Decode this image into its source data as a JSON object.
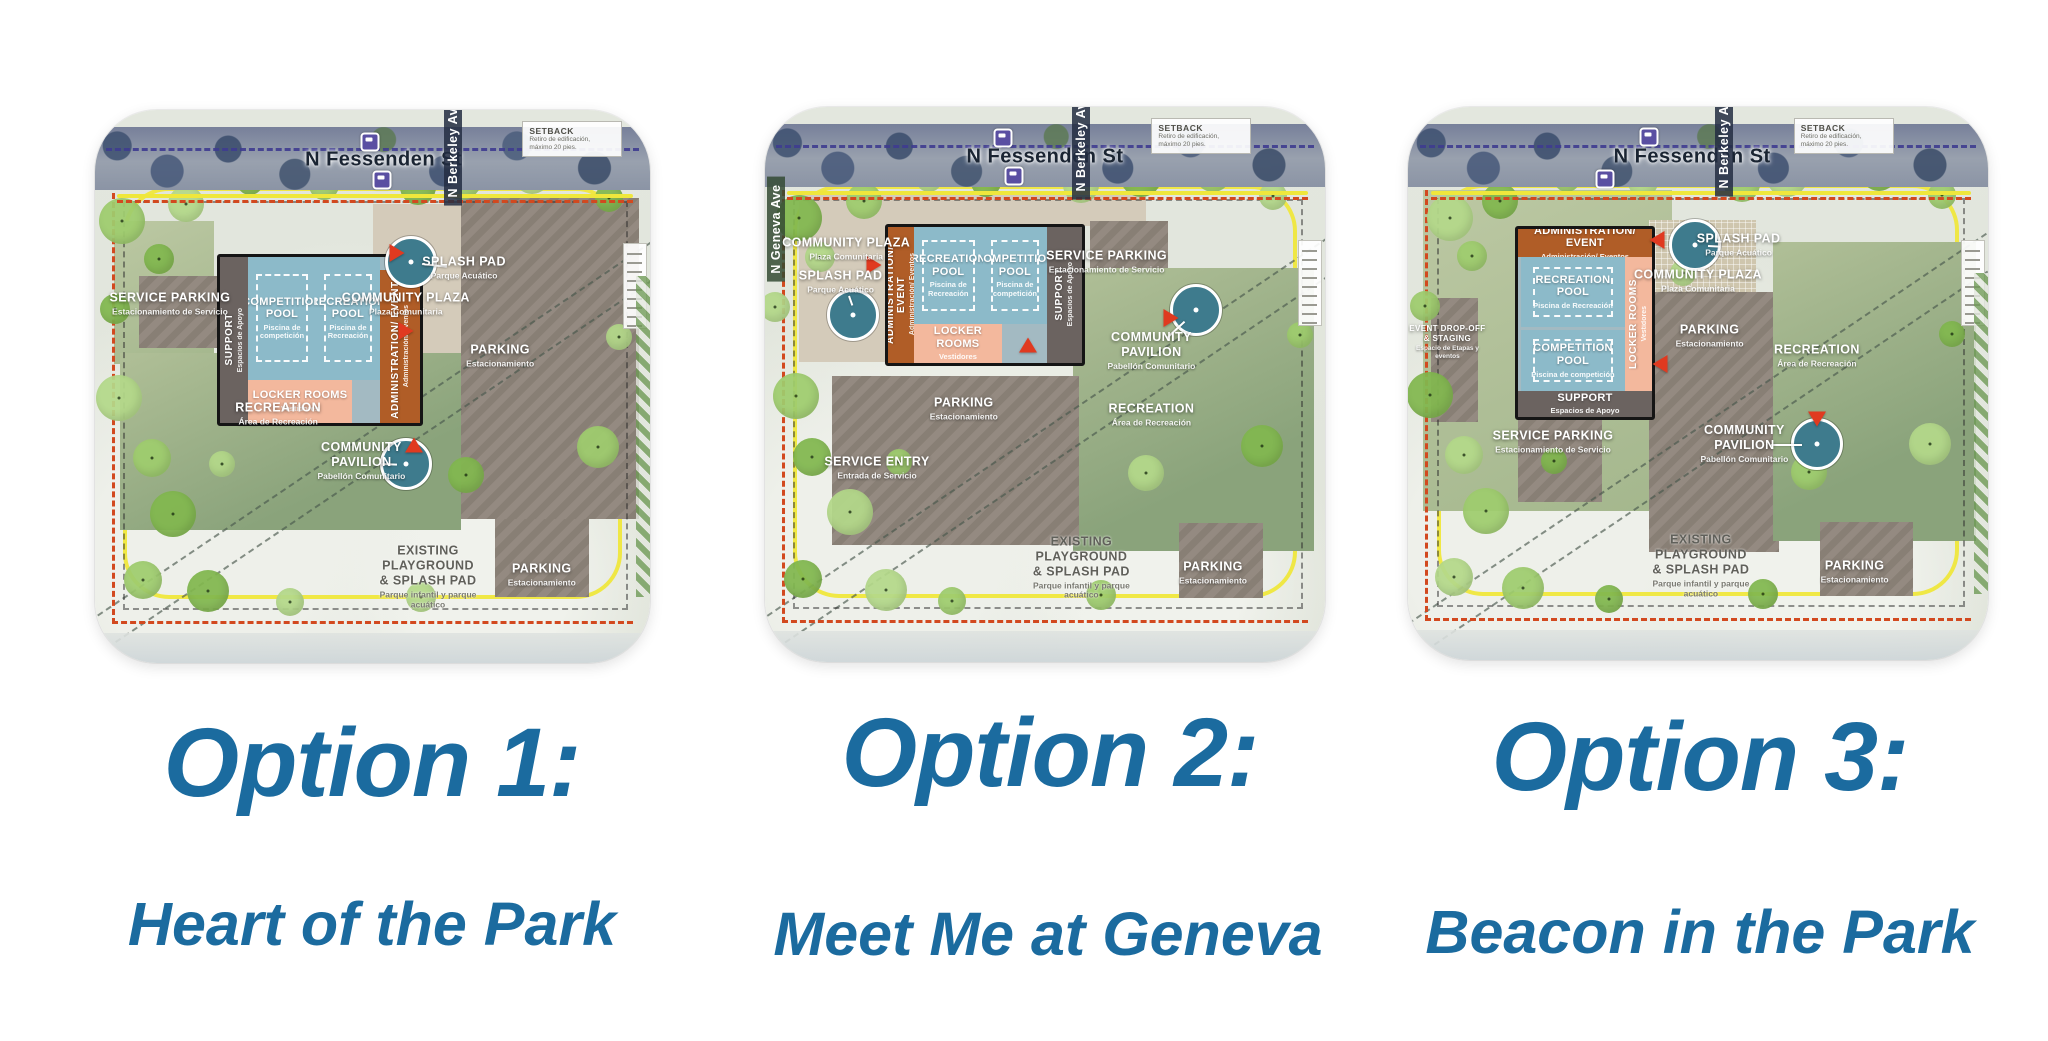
{
  "slide": {
    "background": "#ffffff",
    "caption_color": "#1b6b9f"
  },
  "colors": {
    "pool": "#8cbac9",
    "admin_orange": "#b05d27",
    "locker_pink": "#f3b89d",
    "support_gray": "#6b6360",
    "parking_taupe": "#8e847a",
    "plaza_tan": "#d4cbba",
    "recreation_green": "#9fb289",
    "street_gray": "#8b94a5",
    "teal_circle": "#3e7b8d",
    "path_yellow": "#efe73c",
    "boundary_red": "#d2491f",
    "bike_route_navy": "#3f3c90"
  },
  "maps": [
    {
      "id": "option-1",
      "title": "Option 1:",
      "subtitle": "Heart of the Park",
      "frame": {
        "left": 95,
        "top": 110,
        "width": 555,
        "height": 553
      },
      "streets": {
        "top": "N Fessenden St",
        "top_x": 52,
        "right": "N Berkeley Ave",
        "right_x": 64.5,
        "right_y": 7,
        "left": null
      },
      "setback_note": {
        "title": "SETBACK",
        "lines": [
          "Retiro de edificación,",
          "máximo 20 pies."
        ],
        "x": 77,
        "y": 2
      },
      "zigzag_right": true,
      "areas": [
        {
          "name": "community-plaza-area",
          "kind": "plaza",
          "x": 50,
          "y": 17,
          "w": 26,
          "h": 41
        },
        {
          "name": "west-green-area",
          "kind": "recreation2",
          "x": 3.5,
          "y": 20,
          "w": 18,
          "h": 26
        },
        {
          "name": "main-parking-lot",
          "kind": "parking",
          "x": 66,
          "y": 16,
          "w": 32,
          "h": 58
        },
        {
          "name": "service-parking-lot",
          "kind": "parking",
          "x": 8,
          "y": 30,
          "w": 14.5,
          "h": 13
        },
        {
          "name": "recreation-field",
          "kind": "recreation",
          "x": 4.5,
          "y": 44,
          "w": 61.5,
          "h": 32
        },
        {
          "name": "south-parking-lot",
          "kind": "parking",
          "x": 72,
          "y": 74,
          "w": 17,
          "h": 14
        }
      ],
      "building": {
        "x": 22,
        "y": 26,
        "w": 36,
        "h": 30,
        "parts": [
          {
            "name": "support-wing",
            "label": "SUPPORT",
            "sub": "Espacios de Apoyo",
            "kind": "support",
            "orient": "v",
            "x": 0,
            "y": 0,
            "w": 14,
            "h": 100
          },
          {
            "name": "competition-pool",
            "label": "COMPETITION POOL",
            "sub": "Piscina de competición",
            "kind": "pool",
            "pool": true,
            "x": 14,
            "y": 0,
            "w": 34,
            "h": 74
          },
          {
            "name": "recreation-pool",
            "label": "RECREATION POOL",
            "sub": "Piscina de Recreación",
            "kind": "pool",
            "pool": true,
            "x": 48,
            "y": 0,
            "w": 32,
            "h": 74
          },
          {
            "name": "locker-rooms",
            "label": "LOCKER ROOMS",
            "sub": "Vestidores",
            "kind": "locker",
            "x": 14,
            "y": 74,
            "w": 52,
            "h": 26
          },
          {
            "name": "administration-wing",
            "label": "ADMINISTRATION/ EVENTS",
            "sub": "Administración/ Eventos",
            "kind": "admin",
            "orient": "v",
            "x": 80,
            "y": 8,
            "w": 20,
            "h": 92
          }
        ]
      },
      "labels": [
        {
          "name": "service-parking",
          "text": "SERVICE PARKING",
          "sub": "Estacionamiento de Servicio",
          "x": 13.5,
          "y": 35,
          "tone": "light"
        },
        {
          "name": "splash-pad",
          "text": "SPLASH PAD",
          "sub": "Parque Acuático",
          "x": 66.5,
          "y": 28.5,
          "tone": "light"
        },
        {
          "name": "community-plaza",
          "text": "COMMUNITY PLAZA",
          "sub": "Plaza Comunitaria",
          "x": 56,
          "y": 35,
          "tone": "light"
        },
        {
          "name": "parking",
          "text": "PARKING",
          "sub": "Estacionamiento",
          "x": 73,
          "y": 44.5,
          "tone": "light"
        },
        {
          "name": "recreation",
          "text": "RECREATION",
          "sub": "Área de Recreación",
          "x": 33,
          "y": 55,
          "tone": "light"
        },
        {
          "name": "community-pavilion",
          "text": "COMMUNITY PAVILION",
          "sub": "Pabellón Comunitario",
          "x": 48,
          "y": 63.5,
          "tone": "light"
        },
        {
          "name": "existing-playground",
          "text": "EXISTING PLAYGROUND\n& SPLASH PAD",
          "sub": "Parque infantil y parque acuático",
          "x": 60,
          "y": 84.5,
          "tone": "dark"
        },
        {
          "name": "south-parking",
          "text": "PARKING",
          "sub": "Estacionamiento",
          "x": 80.5,
          "y": 84,
          "tone": "light"
        }
      ],
      "circles": [
        {
          "name": "splash-pad-circle",
          "x": 57,
          "y": 27.5
        },
        {
          "name": "community-pavilion-circle",
          "x": 56,
          "y": 64
        }
      ],
      "leaders": [
        {
          "x1": 59,
          "y1": 27.7,
          "x2": 63.5,
          "y2": 28.2
        },
        {
          "x1": 51.5,
          "y1": 63.8,
          "x2": 54.3,
          "y2": 63.9
        }
      ],
      "markers": [
        {
          "dir": "right",
          "x": 54.5,
          "y": 25.8
        },
        {
          "dir": "right",
          "x": 56,
          "y": 40
        },
        {
          "dir": "up",
          "x": 57.5,
          "y": 60.5
        }
      ],
      "bus_stops": [
        {
          "x": 49.5,
          "y": 5.8
        },
        {
          "x": 51.7,
          "y": 12.7
        }
      ]
    },
    {
      "id": "option-2",
      "title": "Option 2:",
      "subtitle": "Meet Me at Geneva",
      "frame": {
        "left": 765,
        "top": 107,
        "width": 560,
        "height": 555
      },
      "streets": {
        "top": "N Fessenden St",
        "top_x": 50,
        "right": "N Berkeley Ave",
        "right_x": 56.5,
        "right_y": 6.5,
        "left": "N Geneva Ave",
        "left_x": 2,
        "left_y": 22
      },
      "setback_note": {
        "title": "SETBACK",
        "lines": [
          "Retiro de edificación,",
          "máximo 20 pies."
        ],
        "x": 69,
        "y": 2
      },
      "zigzag_right": false,
      "areas": [
        {
          "name": "plaza-top-strip",
          "kind": "plaza",
          "x": 6,
          "y": 15.5,
          "w": 62,
          "h": 6
        },
        {
          "name": "community-plaza-area",
          "kind": "plaza",
          "x": 6,
          "y": 17,
          "w": 15.5,
          "h": 29
        },
        {
          "name": "service-parking-lot",
          "kind": "parking",
          "x": 58,
          "y": 20.5,
          "w": 14,
          "h": 17.5
        },
        {
          "name": "recreation-field",
          "kind": "recreation",
          "x": 55,
          "y": 29,
          "w": 43,
          "h": 51
        },
        {
          "name": "main-parking-lot",
          "kind": "parking",
          "x": 12,
          "y": 48.5,
          "w": 44,
          "h": 30.5
        },
        {
          "name": "south-parking-lot",
          "kind": "parking",
          "x": 74,
          "y": 75,
          "w": 15,
          "h": 13.5
        }
      ],
      "building": {
        "x": 21.5,
        "y": 21,
        "w": 34.5,
        "h": 24.5,
        "parts": [
          {
            "name": "administration-wing",
            "label": "ADMINISTRATION/ EVENT",
            "sub": "Administración/ Eventos",
            "kind": "admin",
            "orient": "v",
            "x": 0,
            "y": 0,
            "w": 13,
            "h": 100
          },
          {
            "name": "recreation-pool",
            "label": "RECREATION POOL",
            "sub": "Piscina de Recreación",
            "kind": "pool",
            "pool": true,
            "x": 13,
            "y": 0,
            "w": 36,
            "h": 72
          },
          {
            "name": "competition-pool",
            "label": "COMPETITION POOL",
            "sub": "Piscina de competición",
            "kind": "pool",
            "pool": true,
            "x": 49,
            "y": 0,
            "w": 33,
            "h": 72
          },
          {
            "name": "support-wing",
            "label": "SUPPORT",
            "sub": "Espacios de Apoyo",
            "kind": "support",
            "orient": "v",
            "x": 82,
            "y": 0,
            "w": 18,
            "h": 100
          },
          {
            "name": "locker-rooms",
            "label": "LOCKER ROOMS",
            "sub": "Vestidores",
            "kind": "locker",
            "x": 13,
            "y": 72,
            "w": 46,
            "h": 28
          }
        ]
      },
      "labels": [
        {
          "name": "community-plaza",
          "text": "COMMUNITY PLAZA",
          "sub": "Plaza Comunitaria",
          "x": 14.5,
          "y": 25.5,
          "tone": "light"
        },
        {
          "name": "splash-pad",
          "text": "SPLASH PAD",
          "sub": "Parque Acuático",
          "x": 13.5,
          "y": 31.5,
          "tone": "light"
        },
        {
          "name": "service-parking",
          "text": "SERVICE PARKING",
          "sub": "Estacionamiento de Servicio",
          "x": 61,
          "y": 28,
          "tone": "light"
        },
        {
          "name": "community-pavilion",
          "text": "COMMUNITY PAVILION",
          "sub": "Pabellón Comunitario",
          "x": 69,
          "y": 44,
          "tone": "light"
        },
        {
          "name": "recreation",
          "text": "RECREATION",
          "sub": "Área de Recreación",
          "x": 69,
          "y": 55.5,
          "tone": "light"
        },
        {
          "name": "parking",
          "text": "PARKING",
          "sub": "Estacionamiento",
          "x": 35.5,
          "y": 54.5,
          "tone": "light"
        },
        {
          "name": "service-entry",
          "text": "SERVICE ENTRY",
          "sub": "Entrada de Servicio",
          "x": 20,
          "y": 65,
          "tone": "light"
        },
        {
          "name": "existing-playground",
          "text": "EXISTING PLAYGROUND\n& SPLASH PAD",
          "sub": "Parque infantil y parque acuático",
          "x": 56.5,
          "y": 83,
          "tone": "dark"
        },
        {
          "name": "south-parking",
          "text": "PARKING",
          "sub": "Estacionamiento",
          "x": 80,
          "y": 84,
          "tone": "light"
        }
      ],
      "circles": [
        {
          "name": "splash-pad-circle",
          "x": 15.7,
          "y": 37.5
        },
        {
          "name": "community-pavilion-circle",
          "x": 77,
          "y": 36.5
        }
      ],
      "leaders": [
        {
          "x1": 15,
          "y1": 33.8,
          "x2": 15.6,
          "y2": 35.5
        },
        {
          "x1": 71.8,
          "y1": 41.5,
          "x2": 75,
          "y2": 38.5
        }
      ],
      "markers": [
        {
          "dir": "right",
          "x": 19.5,
          "y": 28.5
        },
        {
          "dir": "up",
          "x": 47,
          "y": 42.8
        },
        {
          "dir": "right",
          "x": 72.5,
          "y": 38
        }
      ],
      "bus_stops": [
        {
          "x": 42.5,
          "y": 5.5
        },
        {
          "x": 44.5,
          "y": 12.5
        }
      ]
    },
    {
      "id": "option-3",
      "title": "Option 3:",
      "subtitle": "Beacon in the Park",
      "frame": {
        "left": 1408,
        "top": 107,
        "width": 580,
        "height": 553
      },
      "streets": {
        "top": "N Fessenden St",
        "top_x": 49,
        "right": "N Berkeley Ave",
        "right_x": 54.5,
        "right_y": 6,
        "left": null
      },
      "setback_note": {
        "title": "SETBACK",
        "lines": [
          "Retiro de edificación,",
          "máximo 20 pies."
        ],
        "x": 66.5,
        "y": 2
      },
      "zigzag_right": true,
      "areas": [
        {
          "name": "building-green-area",
          "kind": "recreation2",
          "x": 2.5,
          "y": 15,
          "w": 43,
          "h": 58
        },
        {
          "name": "community-plaza-area",
          "kind": "hatch",
          "x": 41.5,
          "y": 20.5,
          "w": 18.5,
          "h": 13.5
        },
        {
          "name": "main-parking-lot",
          "kind": "parking",
          "x": 41.5,
          "y": 33.5,
          "w": 22.5,
          "h": 47
        },
        {
          "name": "recreation-field",
          "kind": "recreation",
          "x": 63,
          "y": 24.5,
          "w": 35,
          "h": 54
        },
        {
          "name": "event-dropoff-driveway",
          "kind": "parking",
          "x": 4,
          "y": 34.5,
          "w": 8,
          "h": 22.5
        },
        {
          "name": "service-parking-lot",
          "kind": "parking",
          "x": 19,
          "y": 56.5,
          "w": 14.5,
          "h": 15
        },
        {
          "name": "south-parking-lot",
          "kind": "parking",
          "x": 71,
          "y": 75,
          "w": 16,
          "h": 13.5
        }
      ],
      "building": {
        "x": 18.5,
        "y": 21.5,
        "w": 23,
        "h": 34,
        "parts": [
          {
            "name": "administration-wing",
            "label": "ADMINISTRATION/ EVENT",
            "sub": "Administración/ Eventos",
            "kind": "admin",
            "x": 0,
            "y": 0,
            "w": 100,
            "h": 15
          },
          {
            "name": "recreation-pool",
            "label": "RECREATION POOL",
            "sub": "Piscina de Recreación",
            "kind": "pool",
            "pool": true,
            "x": 2,
            "y": 15,
            "w": 78,
            "h": 37
          },
          {
            "name": "competition-pool",
            "label": "COMPETITION POOL",
            "sub": "Piscina de competición",
            "kind": "pool",
            "pool": true,
            "x": 2,
            "y": 54,
            "w": 78,
            "h": 32
          },
          {
            "name": "locker-rooms",
            "label": "LOCKER ROOMS",
            "sub": "Vestidores",
            "kind": "locker",
            "orient": "v",
            "x": 80,
            "y": 15,
            "w": 20,
            "h": 71
          },
          {
            "name": "support-wing",
            "label": "SUPPORT",
            "sub": "Espacios de Apoyo",
            "kind": "support",
            "x": 0,
            "y": 86,
            "w": 100,
            "h": 14
          }
        ]
      },
      "labels": [
        {
          "name": "splash-pad",
          "text": "SPLASH PAD",
          "sub": "Parque Acuático",
          "x": 57,
          "y": 25,
          "tone": "light"
        },
        {
          "name": "community-plaza",
          "text": "COMMUNITY PLAZA",
          "sub": "Plaza Comunitaria",
          "x": 50,
          "y": 31.5,
          "tone": "light"
        },
        {
          "name": "parking",
          "text": "PARKING",
          "sub": "Estacionamiento",
          "x": 52,
          "y": 41.5,
          "tone": "light"
        },
        {
          "name": "recreation",
          "text": "RECREATION",
          "sub": "Área de Recreación",
          "x": 70.5,
          "y": 45,
          "tone": "light"
        },
        {
          "name": "service-parking",
          "text": "SERVICE PARKING",
          "sub": "Estacionamiento de Servicio",
          "x": 25,
          "y": 60.5,
          "tone": "light"
        },
        {
          "name": "community-pavilion",
          "text": "COMMUNITY PAVILION",
          "sub": "Pabellón Comunitario",
          "x": 58,
          "y": 61,
          "tone": "light"
        },
        {
          "name": "event-dropoff",
          "text": "EVENT DROP-OFF & STAGING",
          "sub": "Espacio de Etapas y eventos",
          "x": 6.8,
          "y": 42.5,
          "tone": "light",
          "tiny": true
        },
        {
          "name": "existing-playground",
          "text": "EXISTING PLAYGROUND\n& SPLASH PAD",
          "sub": "Parque infantil y parque acuático",
          "x": 50.5,
          "y": 83,
          "tone": "dark"
        },
        {
          "name": "south-parking",
          "text": "PARKING",
          "sub": "Estacionamiento",
          "x": 77,
          "y": 84,
          "tone": "light"
        }
      ],
      "circles": [
        {
          "name": "splash-pad-circle",
          "x": 49.5,
          "y": 25
        },
        {
          "name": "community-pavilion-circle",
          "x": 70.5,
          "y": 61
        }
      ],
      "leaders": [
        {
          "x1": 51.8,
          "y1": 25,
          "x2": 53.8,
          "y2": 25.1
        },
        {
          "x1": 62.5,
          "y1": 61,
          "x2": 68,
          "y2": 61
        }
      ],
      "markers": [
        {
          "dir": "left",
          "x": 43,
          "y": 24
        },
        {
          "dir": "left",
          "x": 43.5,
          "y": 46.5
        },
        {
          "dir": "down",
          "x": 70.5,
          "y": 56.5
        }
      ],
      "bus_stops": [
        {
          "x": 41.5,
          "y": 5.5
        },
        {
          "x": 34,
          "y": 13
        }
      ]
    }
  ]
}
